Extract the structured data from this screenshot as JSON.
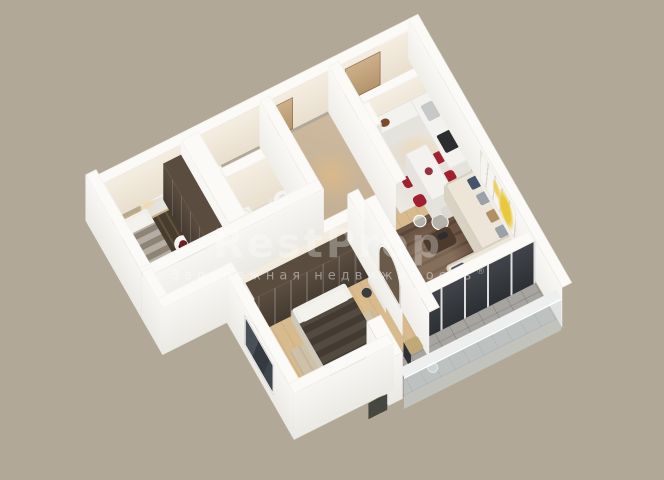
{
  "background_color": "#b1a897",
  "watermark": {
    "title": "RestProp",
    "subtitle": "Зарубежная недвижимость",
    "registered_mark": "®"
  },
  "palette": {
    "bg": "#b1a897",
    "wallTop": "#fbfaf7",
    "accentRed": "#a21f2f",
    "accentYellow": "#e9c83b",
    "pillowNavy": "#45536b",
    "pillowGray": "#9aa1a9",
    "pillowTan": "#b19066",
    "darkWood": "#57493c",
    "floorWood": "#d7bb8e",
    "balconyTile": "#a8a5a0",
    "plantGreen": "#3f6b35"
  },
  "scene": {
    "type": "isometric-3d-apartment-floor-plan-render",
    "rooms": [
      {
        "name": "entry-hall",
        "items": [
          "entry-door",
          "closet-niche"
        ]
      },
      {
        "name": "corridor",
        "items": [
          "interior-doors"
        ]
      },
      {
        "name": "shower-room",
        "items": [
          "shower-tray",
          "glass-screen",
          "sink"
        ]
      },
      {
        "name": "bathroom",
        "items": [
          "bathtub",
          "wood-vanity",
          "toilet"
        ]
      },
      {
        "name": "bedroom-1",
        "items": [
          "striped-bed",
          "dark-patterned-rug",
          "dark-glass-wardrobe",
          "desk-with-lamp",
          "round-side-table-with-flowers"
        ]
      },
      {
        "name": "bedroom-2",
        "items": [
          "dark-striped-bed",
          "sliding-door-wardrobe",
          "beige-rug",
          "curved-dressing-table",
          "stool",
          "arched-niche"
        ]
      },
      {
        "name": "kitchen",
        "items": [
          "l-shaped-white-counter",
          "sink",
          "dark-cooktop",
          "tall-cabinet",
          "white-dining-table",
          "four-red-chairs",
          "white-chair"
        ]
      },
      {
        "name": "living-room",
        "items": [
          "cream-corner-sofa",
          "navy-gray-tan-pillows",
          "dark-wood-coffee-table",
          "glass-side-tables",
          "dark-tv-console",
          "brown-patterned-rug",
          "yellow-abstract-wall-art",
          "dark-glazed-balcony-doors"
        ]
      },
      {
        "name": "balcony",
        "items": [
          "glass-railing",
          "metal-chair",
          "small-side-table",
          "potted-green-plant",
          "white-pier"
        ]
      }
    ]
  }
}
